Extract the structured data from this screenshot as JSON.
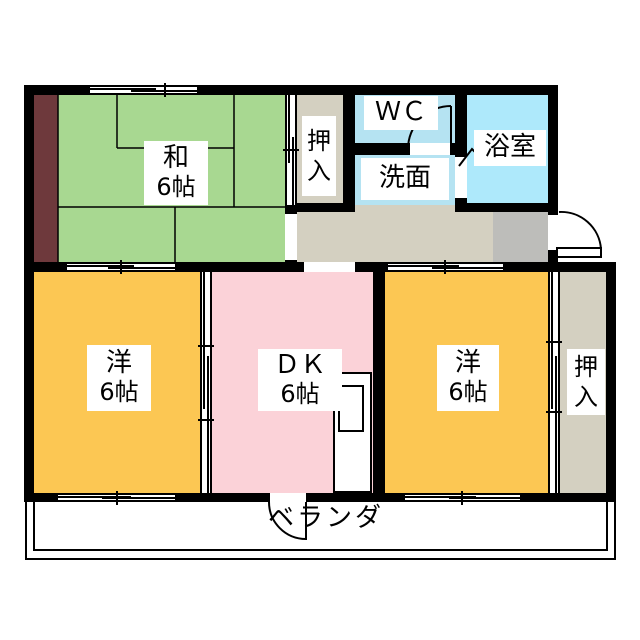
{
  "plan_type": "apartment floor plan",
  "rooms": {
    "japanese_room": {
      "name": "和",
      "size": "6帖",
      "color": "#a8d891"
    },
    "closet_top": {
      "name": "押入",
      "char1": "押",
      "char2": "入",
      "color": "#d4d0c1"
    },
    "wc": {
      "name": "ＷＣ",
      "color": "#b5e3f2"
    },
    "washroom": {
      "name": "洗面",
      "color": "#b5e3f2"
    },
    "bathroom": {
      "name": "浴室",
      "color": "#aee9fb"
    },
    "western_room_left": {
      "name": "洋",
      "size": "6帖",
      "color": "#fcc753"
    },
    "dining_kitchen": {
      "name": "ＤＫ",
      "size": "6帖",
      "color": "#fbd2d8"
    },
    "western_room_right": {
      "name": "洋",
      "size": "6帖",
      "color": "#fcc753"
    },
    "closet_right": {
      "name": "押入",
      "char1": "押",
      "char2": "入",
      "color": "#d4d0c1"
    },
    "veranda": {
      "name": "ベランダ"
    }
  },
  "palette": {
    "wall": "#000000",
    "hallway": "#d4d0c1",
    "entrance_step": "#bdbdba",
    "tatami_border_strip": "#6e393c",
    "background": "#ffffff"
  }
}
